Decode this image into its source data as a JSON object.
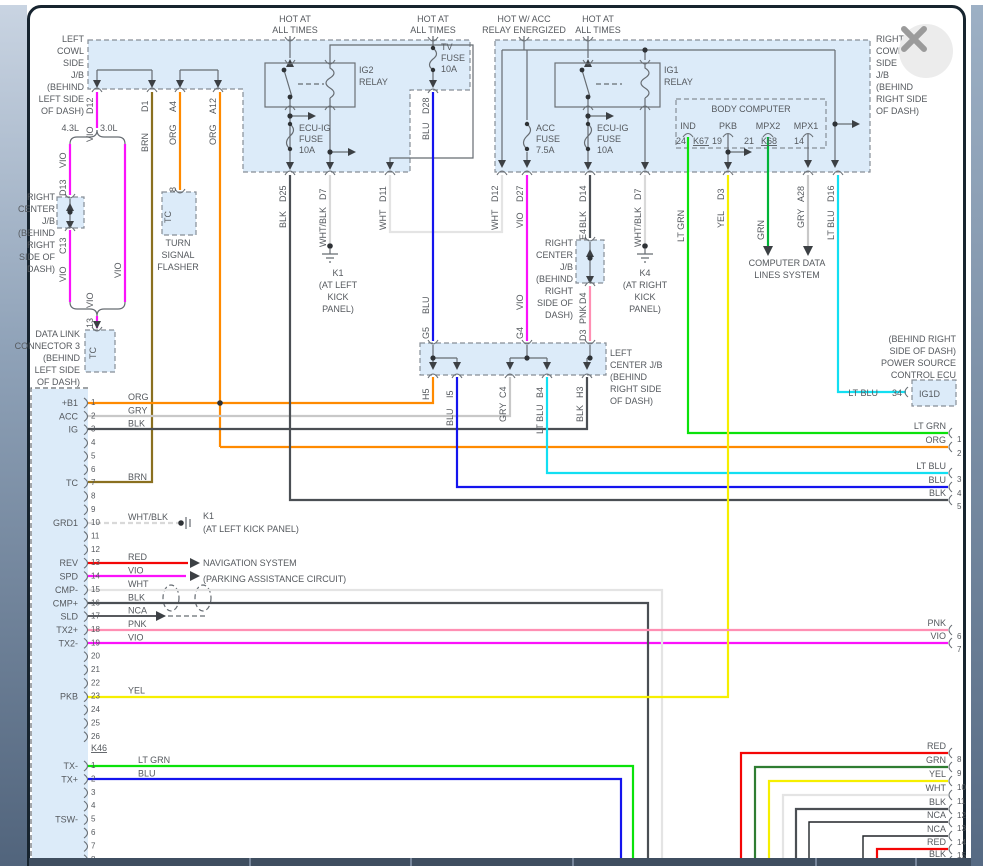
{
  "feeds": {
    "ig2": [
      "HOT AT",
      "ALL TIMES"
    ],
    "tv": [
      "HOT AT",
      "ALL TIMES"
    ],
    "acc": [
      "HOT W/ ACC",
      "RELAY ENERGIZED"
    ],
    "ig1": [
      "HOT AT",
      "ALL TIMES"
    ]
  },
  "relays": {
    "ig2": [
      "IG2",
      "RELAY"
    ],
    "ig1": [
      "IG1",
      "RELAY"
    ]
  },
  "fuses": {
    "ecu_l": [
      "ECU-IG",
      "FUSE",
      "10A"
    ],
    "tv": [
      "TV",
      "FUSE",
      "10A"
    ],
    "acc": [
      "ACC",
      "FUSE",
      "7.5A"
    ],
    "ecu_r": [
      "ECU-IG",
      "FUSE",
      "10A"
    ]
  },
  "labels": {
    "left_cowl": [
      "LEFT",
      "COWL",
      "SIDE",
      "J/B",
      "(BEHIND",
      "LEFT SIDE",
      "OF DASH)"
    ],
    "right_cowl": [
      "RIGHT",
      "COWL",
      "SIDE",
      "J/B",
      "(BEHIND",
      "RIGHT SIDE",
      "OF DASH)"
    ],
    "rc_jb1": [
      "RIGHT",
      "CENTER",
      "J/B",
      "(BEHIND",
      "RIGHT",
      "SIDE OF",
      "DASH)"
    ],
    "rc_jb2": [
      "RIGHT",
      "CENTER",
      "J/B",
      "(BEHIND",
      "RIGHT",
      "SIDE OF",
      "DASH)"
    ],
    "lc_jb": [
      "LEFT",
      "CENTER J/B",
      "(BEHIND",
      "RIGHT SIDE",
      "OF DASH)"
    ],
    "flasher": [
      "TURN",
      "SIGNAL",
      "FLASHER"
    ],
    "dlc3": [
      "DATA LINK",
      "CONNECTOR 3",
      "(BEHIND",
      "LEFT SIDE",
      "OF DASH)"
    ],
    "k1_relay": [
      "K1",
      "(AT LEFT",
      "KICK",
      "PANEL)"
    ],
    "k4_relay": [
      "K4",
      "(AT RIGHT",
      "KICK",
      "PANEL)"
    ],
    "k1_ecu": [
      "K1",
      "(AT LEFT KICK PANEL)"
    ],
    "cdl": [
      "COMPUTER DATA",
      "LINES SYSTEM"
    ],
    "ps_ecu": [
      "(BEHIND RIGHT",
      "SIDE OF DASH)",
      "POWER SOURCE",
      "CONTROL ECU"
    ],
    "nav": "NAVIGATION SYSTEM",
    "park": "(PARKING ASSISTANCE CIRCUIT)"
  },
  "body_computer": {
    "title": "BODY COMPUTER",
    "names": [
      "IND",
      "PKB",
      "MPX2",
      "MPX1"
    ],
    "nums": [
      "24",
      "19",
      "21",
      "14"
    ],
    "conns": [
      "K67",
      "K68"
    ]
  },
  "ps": {
    "wire": "LT BLU",
    "pin": "34",
    "name": "IG1D"
  },
  "variants": {
    "a": "4.3L",
    "b": "3.0L"
  },
  "ecu": {
    "conn1": [
      {
        "num": "1",
        "name": "+B1",
        "wire": "ORG"
      },
      {
        "num": "2",
        "name": "ACC",
        "wire": "GRY"
      },
      {
        "num": "3",
        "name": "IG",
        "wire": "BLK"
      },
      {
        "num": "4"
      },
      {
        "num": "5"
      },
      {
        "num": "6"
      },
      {
        "num": "7",
        "name": "TC",
        "wire": "BRN"
      },
      {
        "num": "8"
      },
      {
        "num": "9"
      },
      {
        "num": "10",
        "name": "GRD1",
        "wire": "WHT/BLK"
      },
      {
        "num": "11"
      },
      {
        "num": "12"
      },
      {
        "num": "13",
        "name": "REV",
        "wire": "RED"
      },
      {
        "num": "14",
        "name": "SPD",
        "wire": "VIO"
      },
      {
        "num": "15",
        "name": "CMP-",
        "wire": "WHT"
      },
      {
        "num": "16",
        "name": "CMP+",
        "wire": "BLK"
      },
      {
        "num": "17",
        "name": "SLD",
        "wire": "NCA"
      },
      {
        "num": "18",
        "name": "TX2+",
        "wire": "PNK"
      },
      {
        "num": "19",
        "name": "TX2-",
        "wire": "VIO"
      },
      {
        "num": "20"
      },
      {
        "num": "21"
      },
      {
        "num": "22"
      },
      {
        "num": "23",
        "name": "PKB",
        "wire": "YEL"
      },
      {
        "num": "24"
      },
      {
        "num": "25"
      },
      {
        "num": "26"
      }
    ],
    "conn1_name": "K46",
    "conn2": [
      {
        "num": "1",
        "name": "TX-",
        "wire": "LT GRN"
      },
      {
        "num": "2",
        "name": "TX+",
        "wire": "BLU"
      },
      {
        "num": "3"
      },
      {
        "num": "4"
      },
      {
        "num": "5",
        "name": "TSW-"
      },
      {
        "num": "6"
      },
      {
        "num": "7"
      },
      {
        "num": "8"
      }
    ]
  },
  "edge_pins": [
    {
      "num": "1",
      "wire": "LT GRN",
      "y": 433
    },
    {
      "num": "2",
      "wire": "ORG",
      "y": 447
    },
    {
      "num": "3",
      "wire": "LT BLU",
      "y": 473
    },
    {
      "num": "4",
      "wire": "BLU",
      "y": 487
    },
    {
      "num": "5",
      "wire": "BLK",
      "y": 500
    },
    {
      "num": "6",
      "wire": "PNK",
      "y": 630
    },
    {
      "num": "7",
      "wire": "VIO",
      "y": 643
    },
    {
      "num": "8",
      "wire": "RED",
      "y": 753
    },
    {
      "num": "9",
      "wire": "GRN",
      "y": 767
    },
    {
      "num": "10",
      "wire": "YEL",
      "y": 781
    },
    {
      "num": "11",
      "wire": "WHT",
      "y": 795
    },
    {
      "num": "12",
      "wire": "BLK",
      "y": 809
    },
    {
      "num": "13",
      "wire": "NCA",
      "y": 822
    },
    {
      "num": "14",
      "wire": "NCA",
      "y": 836
    },
    {
      "num": "15",
      "wire": "RED",
      "y": 849
    },
    {
      "num": "16",
      "wire": "BLK",
      "y": 861
    }
  ],
  "wire_tags": [
    "D12",
    "VIO",
    "4.3L",
    "3.0L",
    "VIO",
    "D13",
    "C13",
    "VIO",
    "VIO",
    "VIO",
    "13",
    "D1",
    "BRN",
    "A4",
    "ORG",
    "8",
    "A12",
    "ORG",
    "D25",
    "BLK",
    "D7",
    "WHT/BLK",
    "D11",
    "WHT",
    "D28",
    "BLU",
    "BLU",
    "G5",
    "D12",
    "WHT",
    "D27",
    "VIO",
    "VIO",
    "G4",
    "D14",
    "BLK",
    "E4",
    "D4",
    "PNK",
    "D3",
    "D7",
    "WHT/BLK",
    "LT GRN",
    "D3",
    "YEL",
    "GRN",
    "A28",
    "GRY",
    "D16",
    "LT BLU",
    "H5",
    "I5",
    "BLU",
    "C4",
    "GRY",
    "B4",
    "LT BLU",
    "H3",
    "BLK",
    "TC",
    "TC"
  ],
  "colors": {
    "VIO": "#fb12fb",
    "BRN": "#8a7020",
    "ORG": "#ff8a00",
    "BLK": "#4b4f54",
    "WHT": "#e4e4e4",
    "WHT_BLK": "#d9d9d9",
    "BLU": "#1414ee",
    "LT_BLU": "#12dff2",
    "LT_GRN": "#0ae20a",
    "GRN": "#00b437",
    "YEL": "#f6ef00",
    "RED": "#f40606",
    "PNK": "#ff8fb3",
    "GRY": "#c8c8c8",
    "NCA": "#202428",
    "shade": "#dcebf9",
    "frame": "#51647c",
    "bar": "#3f4e60"
  }
}
